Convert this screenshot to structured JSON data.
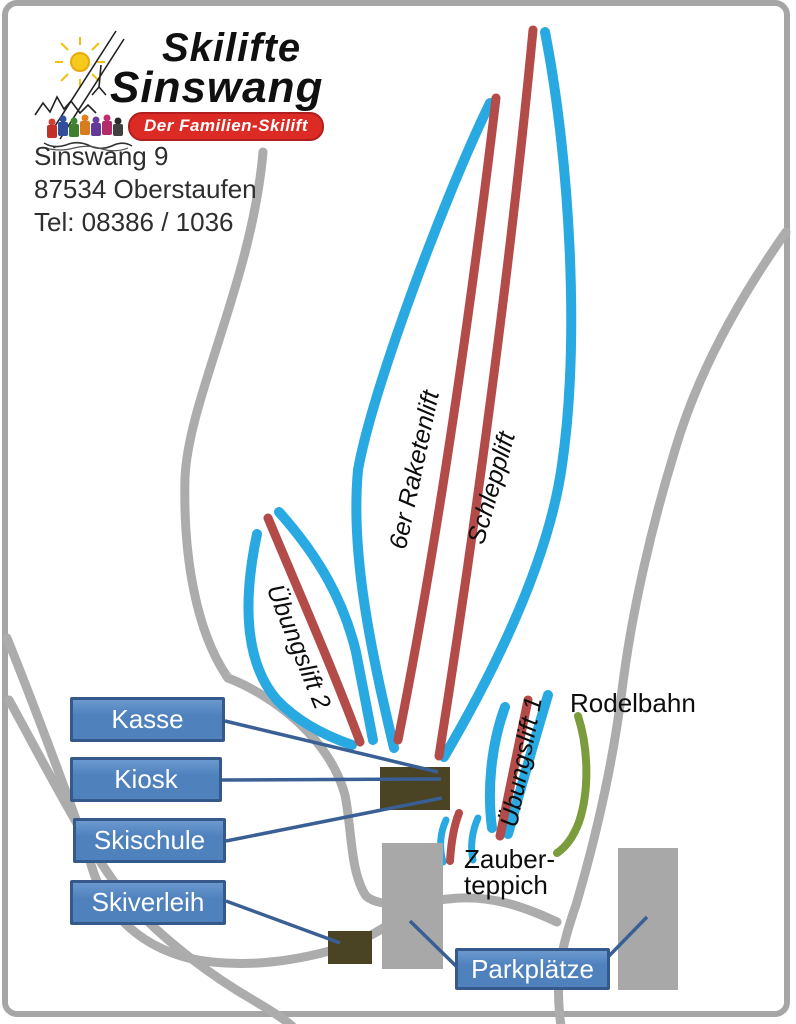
{
  "logo": {
    "title_line1": "Skilifte",
    "title_line2": "Sinswang",
    "tagline": "Der Familien-Skilift"
  },
  "contact": {
    "address_line1": "Sinswang 9",
    "address_line2": "87534 Oberstaufen",
    "phone": "Tel: 08386 / 1036"
  },
  "map": {
    "lift_labels": {
      "raketenlift": "6er Raketenlift",
      "schlepplift": "Schlepplift",
      "uebungslift2": "Übungslift 2",
      "uebungslift1": "Übungslift 1"
    },
    "feature_labels": {
      "rodelbahn": "Rodelbahn",
      "zauberteppich_line1": "Zauber-",
      "zauberteppich_line2": "teppich"
    },
    "poi_labels": {
      "kasse": "Kasse",
      "kiosk": "Kiosk",
      "skischule": "Skischule",
      "skiverleih": "Skiverleih",
      "parkplaetze": "Parkplätze"
    },
    "legend_colors": {
      "piste_blue": "#29A9E2",
      "lift_red": "#B34B49",
      "rodelbahn_green": "#7A9C3D",
      "road_gray": "#ACACAC",
      "poi_box_blue": "#4F81BD",
      "building_dark": "#4A4424",
      "building_gray": "#A8A8A8"
    }
  }
}
